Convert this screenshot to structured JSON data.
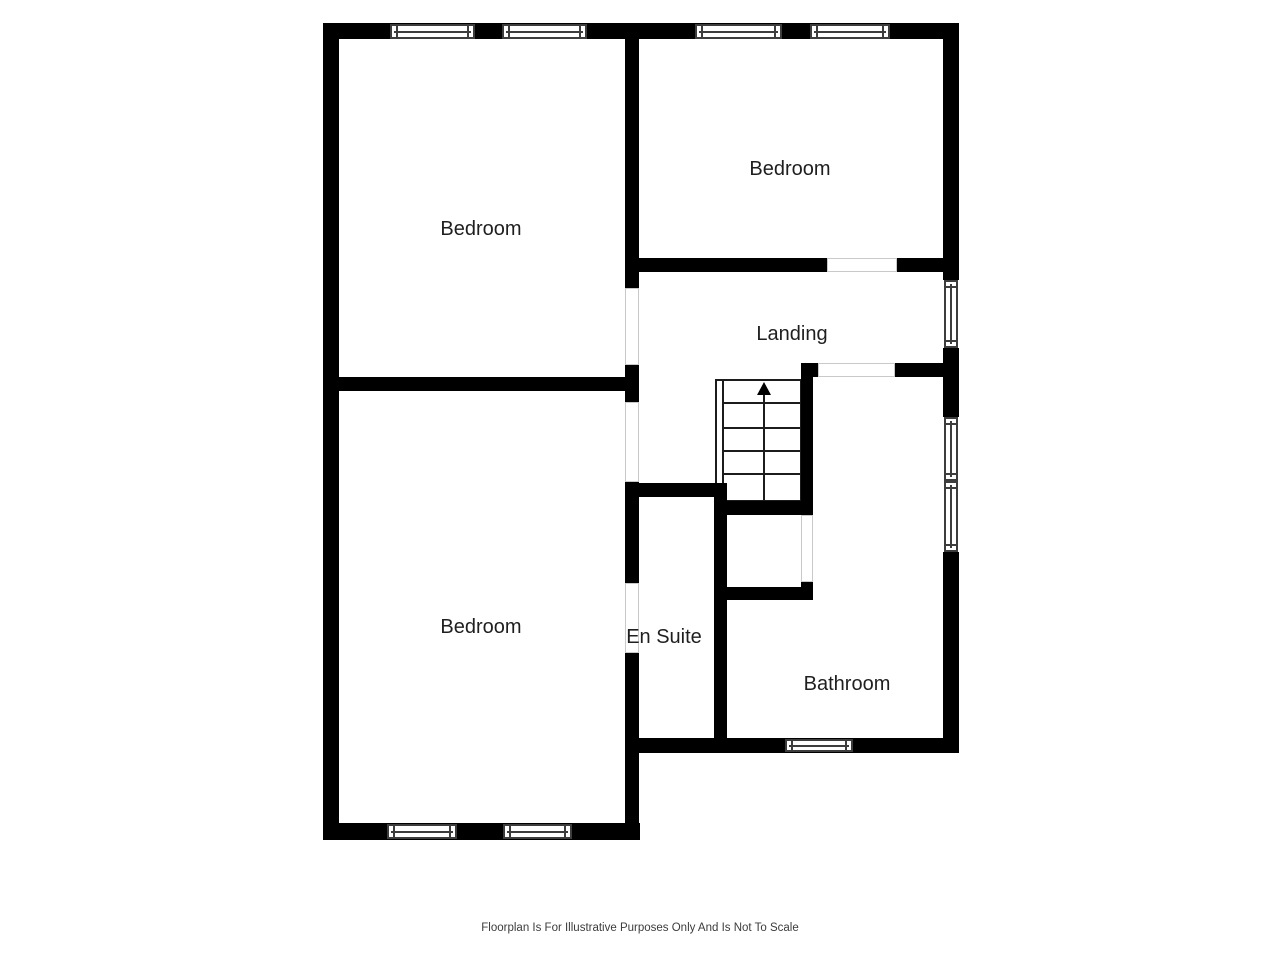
{
  "floorplan": {
    "rooms": {
      "bedroom_top_left": "Bedroom",
      "bedroom_top_right": "Bedroom",
      "bedroom_bottom": "Bedroom",
      "landing": "Landing",
      "en_suite": "En Suite",
      "bathroom": "Bathroom"
    },
    "stairs": {
      "direction_icon": "up-arrow"
    },
    "footer": "Floorplan Is For Illustrative Purposes Only And Is Not To Scale",
    "colors": {
      "wall": "#000000",
      "background": "#ffffff",
      "detail_line": "#3d3d3d",
      "label_text": "#1f1f1f"
    }
  }
}
